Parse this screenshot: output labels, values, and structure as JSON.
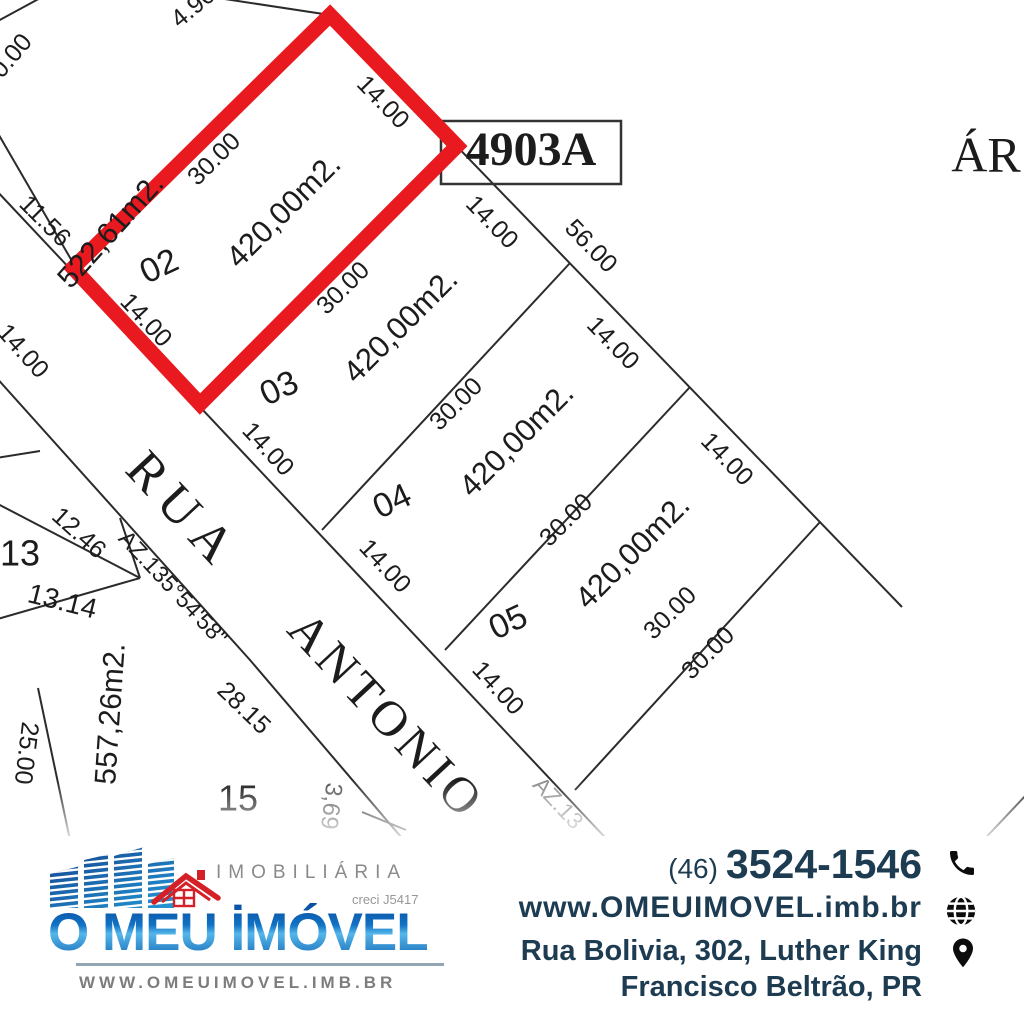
{
  "map": {
    "highlight_color": "#e8191f",
    "line_color": "#2b2b2b",
    "parcel_box_label": "4903A",
    "corner_text_cut": "ÁR",
    "street_name": "RUA ANTONIO",
    "bearing": "AZ.135°54'58\"",
    "labels": [
      {
        "t": "30.00",
        "x": 8,
        "y": 62,
        "r": -50,
        "s": 25
      },
      {
        "t": "4.90",
        "x": 194,
        "y": 8,
        "r": -40,
        "s": 25
      },
      {
        "t": "522,61m2.",
        "x": 112,
        "y": 232,
        "r": -48,
        "s": 30
      },
      {
        "t": "11.56",
        "x": 44,
        "y": 222,
        "r": 45,
        "s": 25
      },
      {
        "t": "14.00",
        "x": 22,
        "y": 352,
        "r": 48,
        "s": 25
      },
      {
        "t": "02",
        "x": 160,
        "y": 268,
        "r": -25,
        "s": 34
      },
      {
        "t": "30.00",
        "x": 215,
        "y": 160,
        "r": -45,
        "s": 25
      },
      {
        "t": "420,00m2.",
        "x": 285,
        "y": 212,
        "r": -45,
        "s": 31
      },
      {
        "t": "14.00",
        "x": 382,
        "y": 103,
        "r": 46,
        "s": 25
      },
      {
        "t": "14.00",
        "x": 145,
        "y": 321,
        "r": 47,
        "s": 25
      },
      {
        "t": "4903A",
        "x": 531,
        "y": 154,
        "r": 0,
        "s": 48,
        "serif": true,
        "b": true,
        "layer": "under"
      },
      {
        "t": "14.00",
        "x": 491,
        "y": 223,
        "r": 46,
        "s": 25
      },
      {
        "t": "56.00",
        "x": 590,
        "y": 247,
        "r": 46,
        "s": 25
      },
      {
        "t": "30.00",
        "x": 344,
        "y": 289,
        "r": -45,
        "s": 25
      },
      {
        "t": "420,00m2.",
        "x": 402,
        "y": 327,
        "r": -45,
        "s": 31
      },
      {
        "t": "03",
        "x": 280,
        "y": 390,
        "r": -25,
        "s": 34
      },
      {
        "t": "14.00",
        "x": 267,
        "y": 450,
        "r": 47,
        "s": 25
      },
      {
        "t": "14.00",
        "x": 612,
        "y": 344,
        "r": 46,
        "s": 25
      },
      {
        "t": "30.00",
        "x": 457,
        "y": 405,
        "r": -45,
        "s": 25
      },
      {
        "t": "420,00m2.",
        "x": 518,
        "y": 441,
        "r": -45,
        "s": 31
      },
      {
        "t": "04",
        "x": 393,
        "y": 503,
        "r": -25,
        "s": 34
      },
      {
        "t": "14.00",
        "x": 384,
        "y": 567,
        "r": 47,
        "s": 25
      },
      {
        "t": "14.00",
        "x": 726,
        "y": 460,
        "r": 46,
        "s": 25
      },
      {
        "t": "30.00",
        "x": 567,
        "y": 521,
        "r": -45,
        "s": 25
      },
      {
        "t": "420,00m2.",
        "x": 634,
        "y": 553,
        "r": -45,
        "s": 31
      },
      {
        "t": "05",
        "x": 509,
        "y": 624,
        "r": -25,
        "s": 34
      },
      {
        "t": "14.00",
        "x": 497,
        "y": 689,
        "r": 47,
        "s": 25
      },
      {
        "t": "30.00",
        "x": 671,
        "y": 614,
        "r": -45,
        "s": 25
      },
      {
        "t": "30.00",
        "x": 709,
        "y": 654,
        "r": -45,
        "s": 25
      },
      {
        "t": "13",
        "x": 20,
        "y": 556,
        "r": 0,
        "s": 36
      },
      {
        "t": "12.46",
        "x": 78,
        "y": 534,
        "r": 42,
        "s": 25
      },
      {
        "t": "13.14",
        "x": 62,
        "y": 603,
        "r": 14,
        "s": 28
      },
      {
        "t": "557,26m2.",
        "x": 112,
        "y": 714,
        "r": -86,
        "s": 30
      },
      {
        "t": "25.00",
        "x": 25,
        "y": 753,
        "r": 97,
        "s": 25
      },
      {
        "t": "15",
        "x": 238,
        "y": 801,
        "r": 0,
        "s": 36
      },
      {
        "t": "28.15",
        "x": 243,
        "y": 709,
        "r": 44,
        "s": 25
      },
      {
        "t": "AZ.135°54'58\"",
        "x": 172,
        "y": 589,
        "r": 47,
        "s": 23
      },
      {
        "t": "AZ.13",
        "x": 557,
        "y": 804,
        "r": 47,
        "s": 23,
        "o": 0.5
      },
      {
        "t": "3,69",
        "x": 330,
        "y": 806,
        "r": 97,
        "s": 24,
        "o": 0.75
      },
      {
        "t": "RUA",
        "x": 180,
        "y": 514,
        "r": 47,
        "s": 52,
        "serif": true,
        "sp": 10
      },
      {
        "t": "ANTONIO",
        "x": 383,
        "y": 719,
        "r": 47,
        "s": 50,
        "serif": true,
        "sp": 5
      },
      {
        "t": "ÁR",
        "x": 986,
        "y": 160,
        "r": 0,
        "s": 50,
        "serif": true,
        "a": "start"
      }
    ]
  },
  "footer": {
    "logo": {
      "tagline": "IMOBILIÁRIA",
      "creci": "creci J5417",
      "name": "O MEU İMÓVEL",
      "website": "WWW.OMEUIMOVEL.IMB.BR"
    },
    "contact": {
      "phone_area": "(46)",
      "phone_number": "3524-1546",
      "website": "www.OMEUIMOVEL.imb.br",
      "address_line1": "Rua Bolivia, 302,  Luther King",
      "address_line2": "Francisco Beltrão, PR",
      "text_color": "#1d3c52"
    }
  }
}
